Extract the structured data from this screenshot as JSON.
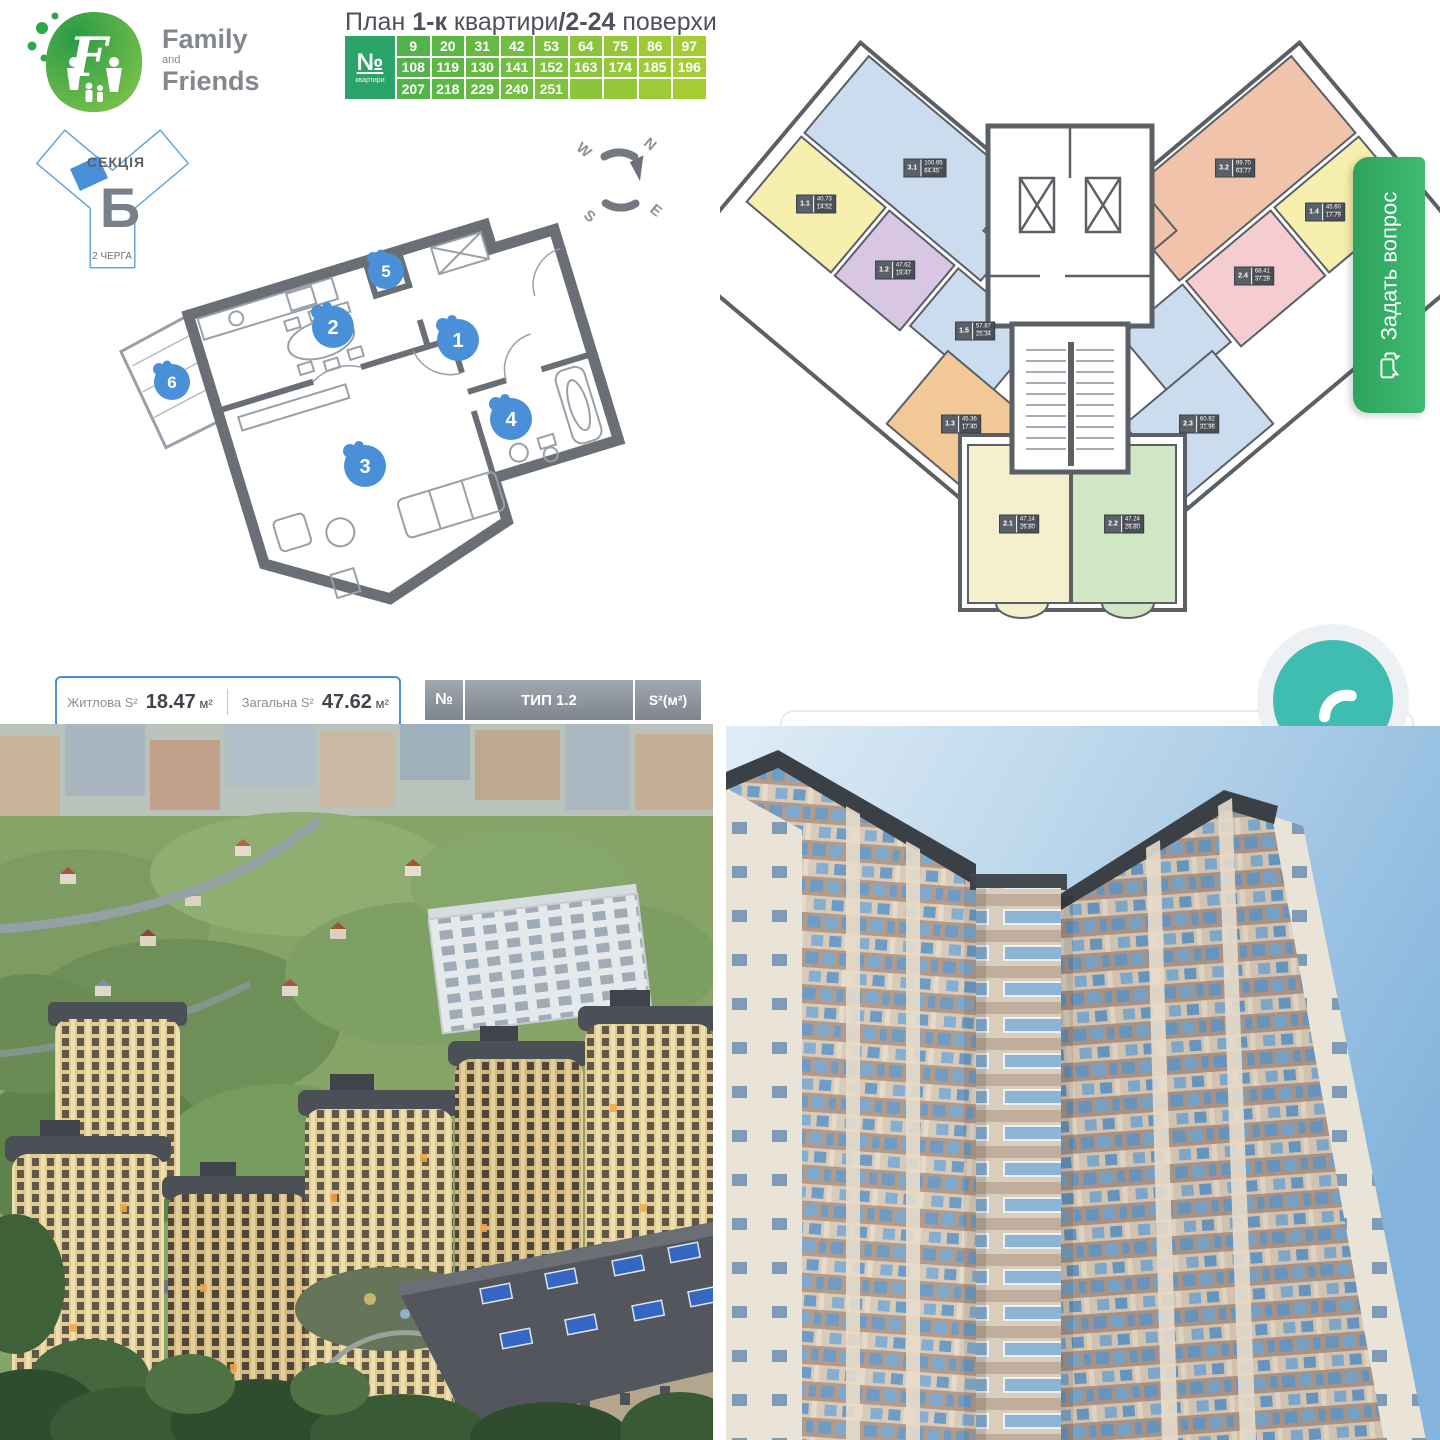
{
  "brand": {
    "family": "Family",
    "and": "and",
    "friends": "Friends"
  },
  "plan_title": {
    "t1": "План ",
    "b1": "1-к",
    "t2": " квартири",
    "sep": "/",
    "b2": "2-24",
    "t3": " поверхи"
  },
  "apt_table": {
    "no": "№",
    "no_sub": "квартири",
    "rows": [
      [
        "9",
        "20",
        "31",
        "42",
        "53",
        "64",
        "75",
        "86",
        "97"
      ],
      [
        "108",
        "119",
        "130",
        "141",
        "152",
        "163",
        "174",
        "185",
        "196"
      ],
      [
        "207",
        "218",
        "229",
        "240",
        "251",
        "",
        "",
        "",
        ""
      ]
    ]
  },
  "section_badge": {
    "label": "СЕКЦІЯ",
    "letter": "Б",
    "phase": "2 ЧЕРГА"
  },
  "compass": {
    "n": "N",
    "e": "E",
    "s": "S",
    "w": "W"
  },
  "markers": [
    "1",
    "2",
    "3",
    "4",
    "5",
    "6"
  ],
  "area_bar": {
    "living_label": "Житлова S²",
    "living_value": "18.47",
    "total_label": "Загальна S²",
    "total_value": "47.62",
    "unit": "м²"
  },
  "type_header": {
    "no": "№",
    "type": "ТИП 1.2",
    "area": "S²(м²)"
  },
  "units": [
    {
      "id": "3.1",
      "top": "100.95",
      "bottom": "64.45",
      "fill": "#cbdcee"
    },
    {
      "id": "1.1",
      "top": "40.73",
      "bottom": "14.52",
      "fill": "#f6efae"
    },
    {
      "id": "1.2",
      "top": "47.62",
      "bottom": "18.47",
      "fill": "#d9c6e2"
    },
    {
      "id": "1.5",
      "top": "57.87",
      "bottom": "25.34",
      "fill": "#cbdcee"
    },
    {
      "id": "1.3",
      "top": "45.36",
      "bottom": "17.40",
      "fill": "#f3c897"
    },
    {
      "id": "3.2",
      "top": "99.70",
      "bottom": "63.77",
      "fill": "#f1c3ab"
    },
    {
      "id": "1.4",
      "top": "45.60",
      "bottom": "17.79",
      "fill": "#f6efae"
    },
    {
      "id": "2.4",
      "top": "68.41",
      "bottom": "37.28",
      "fill": "#f5cdd1"
    },
    {
      "id": "2.3",
      "top": "60.92",
      "bottom": "31.96",
      "fill": "#cbdcee"
    },
    {
      "id": "2.1",
      "top": "47.14",
      "bottom": "26.80",
      "fill": "#f4f0cd"
    },
    {
      "id": "2.2",
      "top": "47.24",
      "bottom": "26.80",
      "fill": "#cfe7c3"
    }
  ],
  "ask_button": {
    "label": "Задать вопрос"
  },
  "colors": {
    "accent_blue": "#4a90d9",
    "marker_blue": "#4a90d8",
    "wall_gray": "#6a6f76",
    "button_green": "#3dbb70",
    "phone_teal": "#3fbdb1",
    "table_green": "#2aa468"
  }
}
